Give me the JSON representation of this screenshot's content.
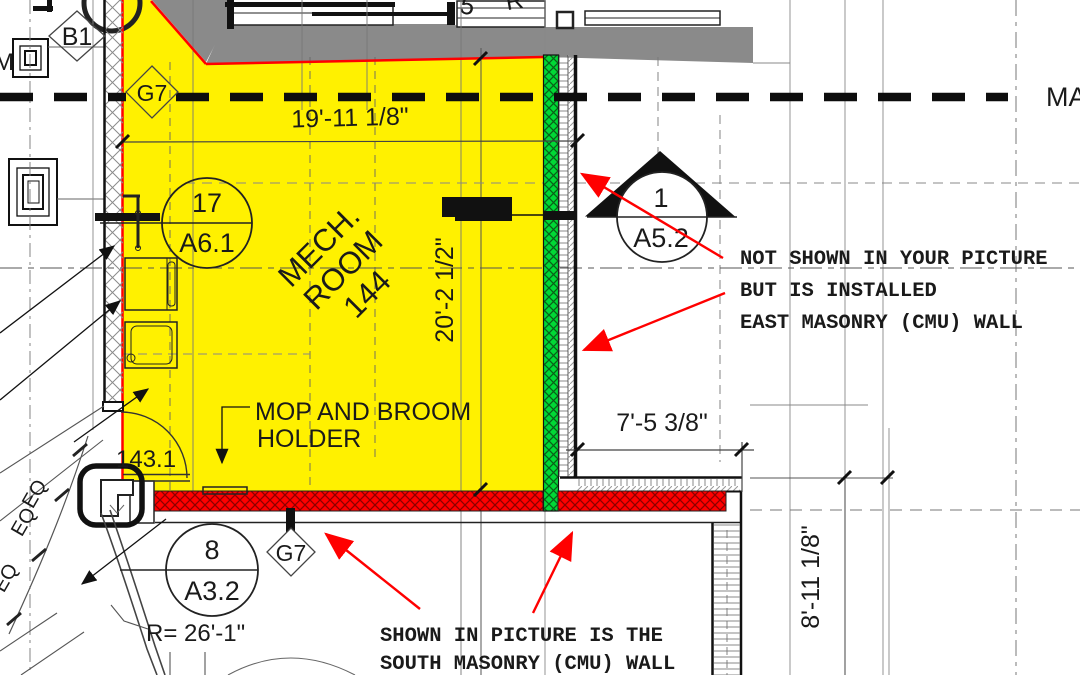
{
  "drawing": {
    "room": {
      "name_line1": "MECH.",
      "name_line2": "ROOM",
      "name_line3": "144"
    },
    "labels": {
      "mop_line1": "MOP AND BROOM",
      "mop_line2": "HOLDER",
      "door_number": "143.1",
      "radius": "R= 26'-1\"",
      "match_line": "MA",
      "left_letter": "M",
      "top_cut_glyph_1": "5",
      "top_cut_glyph_2": "R"
    },
    "dimensions": {
      "top": "19'-11 1/8\"",
      "room_vertical": "20'-2 1/2\"",
      "east_offset": "7'-5 3/8\"",
      "right_vertical": "8'-11 1/8\"",
      "eq": "EQ"
    },
    "grid_bubbles": {
      "b1": "B1",
      "g7": "G7"
    },
    "callouts": {
      "c1_top": "17",
      "c1_bottom": "A6.1",
      "c2_top": "1",
      "c2_bottom": "A5.2",
      "c3_top": "8",
      "c3_bottom": "A3.2"
    },
    "annotations": {
      "east_wall": {
        "line1": "NOT SHOWN IN YOUR PICTURE",
        "line2": "BUT IS INSTALLED",
        "line3": "EAST MASONRY (CMU) WALL"
      },
      "south_wall": {
        "line1": "SHOWN IN PICTURE IS THE",
        "line2": "SOUTH MASONRY (CMU) WALL"
      }
    },
    "colors": {
      "room_highlight": "#FFF100",
      "east_wall_green": "#00D936",
      "south_wall_red": "#FF0000",
      "existing_gray": "#8A8A8A",
      "annotation_red": "#FF0000"
    }
  }
}
